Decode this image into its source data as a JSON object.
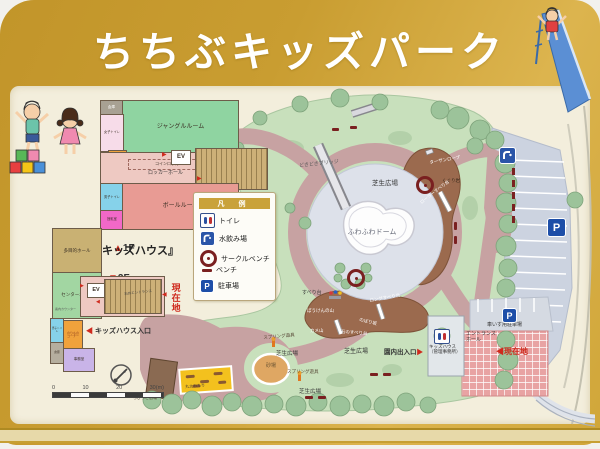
{
  "sign": {
    "title": "ちちぶキッズパーク"
  },
  "colors": {
    "frame_gold": "#c99d31",
    "panel_cream": "#f3eedc",
    "lawn_green": "#c8e0bc",
    "path_pink": "#c7a2a2",
    "hill_brown": "#9b6a4e",
    "parking_gray": "#ccd3e0",
    "current_location_red": "#cf2a1d",
    "sign_blue": "#1d4ea8"
  },
  "floor_plan": {
    "f1_arrow": "▲",
    "f1_label": "1F",
    "building": "『キッズハウス』",
    "f2_arrow": "▼",
    "f2_label": "2F",
    "f1": {
      "storage": "倉庫",
      "womens_toilet": "女子トイレ",
      "accessible_toilet": "多目的\nトイレ",
      "jungle_room": "ジャングルルーム",
      "coin_locker": "コインロッカー",
      "locker_hall": "ロッカーホール",
      "elevator": "EV",
      "mens_toilet": "男子トイレ",
      "nursing_room": "授乳室",
      "ball_room": "ボールルーム",
      "arrow_right": "▶"
    },
    "f2": {
      "multipurpose_hall": "多目的ホール",
      "center_hall": "センターホール",
      "info_counter": "案内カウンター",
      "elevator": "EV",
      "stone_entrance": "石のエントランス",
      "ride_corner": "のりもの\nコーナー",
      "storage": "倉庫",
      "office": "事務室",
      "mens_toilet": "男子トイレ",
      "arrow_right": "▶",
      "arrow_left": "◀"
    },
    "current_location": "現在地",
    "current_location_arrow": "◀",
    "entrance_arrow": "◀",
    "entrance_label": "キッズハウス入口"
  },
  "legend": {
    "header": "凡 例",
    "items": [
      {
        "icon": "toilet-icon",
        "label": "トイレ"
      },
      {
        "icon": "fountain-icon",
        "label": "水飲み場"
      },
      {
        "icon": "circle-bench-icon",
        "label": "サークルベンチ"
      },
      {
        "icon": "bench-icon",
        "label": "ベンチ"
      },
      {
        "icon": "parking-icon",
        "label": "駐車場"
      }
    ]
  },
  "map": {
    "fuwafuwa_dome": "ふわふわドーム",
    "dokidoki_bridge": "どきどきブリッジ",
    "lawn_plaza": "芝生広場",
    "spring_toy": "スプリング遊具",
    "sandbox": "砂場",
    "slide": "すべり台",
    "adventure_hill": "ぼうけんの山",
    "kame_hill": "カメ山",
    "stone_slide": "石のすべり台",
    "climbing_slope": "のぼり坂",
    "long_slide": "ロングすべり台",
    "tarzan_rope": "ターザンロープ",
    "kuguri_rock": "くぐり岩",
    "roller_slide": "ローラーすべり台",
    "log_play": "丸太わたり",
    "chibikko": "ちびっこ広場",
    "exit_text": "園内出入口",
    "exit_arrow": "▶",
    "wheelchair_parking": "車いす用駐車場",
    "kids_house_office": "キッズハウス\n（管理事務所）",
    "entrance_hall": "エントランス\nホール",
    "current_location_arrow": "◀",
    "current_location": "現在地",
    "parking_p": "P",
    "scale_ticks": [
      "0",
      "10",
      "20",
      "30(m)"
    ]
  }
}
